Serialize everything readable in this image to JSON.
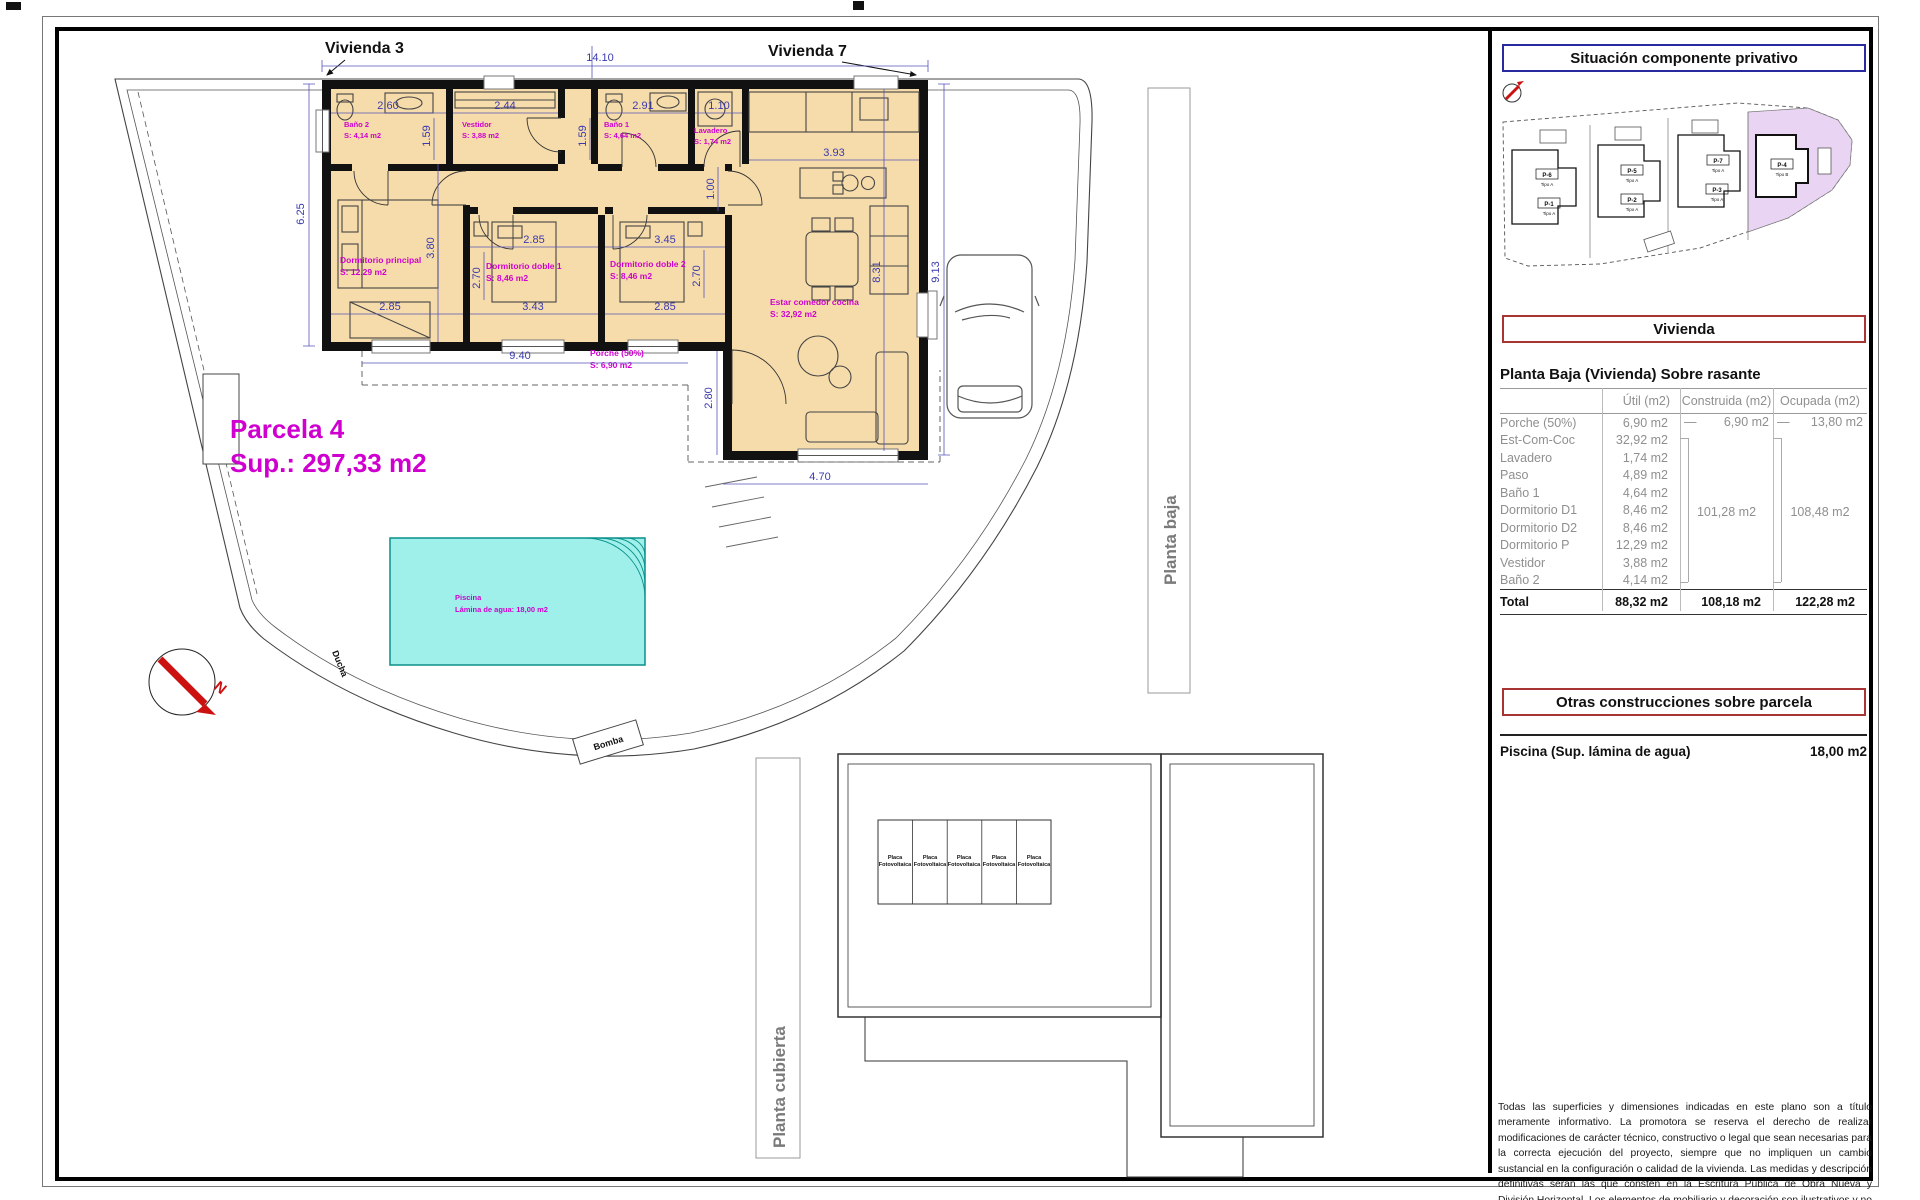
{
  "titles": {
    "vivienda3": "Vivienda 3",
    "vivienda7": "Vivienda 7"
  },
  "parcela": {
    "name": "Parcela 4",
    "area": "Sup.: 297,33 m2"
  },
  "rooms": {
    "bano2": {
      "name": "Baño 2",
      "area": "S: 4,14 m2"
    },
    "vestidor": {
      "name": "Vestidor",
      "area": "S: 3,88 m2"
    },
    "bano1": {
      "name": "Baño 1",
      "area": "S: 4,64 m2"
    },
    "lavadero": {
      "name": "Lavadero",
      "area": "S: 1,74 m2"
    },
    "dormp": {
      "name": "Dormitorio principal",
      "area": "S: 12,29 m2"
    },
    "doble1": {
      "name": "Dormitorio doble 1",
      "area": "S: 8,46 m2"
    },
    "doble2": {
      "name": "Dormitorio doble 2",
      "area": "S: 8,46 m2"
    },
    "estar": {
      "name": "Estar comedor cocina",
      "area": "S: 32,92 m2"
    },
    "porche": {
      "name": "Porche (50%)",
      "area": "S: 6,90 m2"
    }
  },
  "piscina": {
    "name": "Piscina",
    "area": "Lámina de agua: 18,00 m2"
  },
  "dims": {
    "total_w": "14.10",
    "left_h": "6.25",
    "right_h": "9.13",
    "bano2_w": "2.60",
    "vestidor_w": "2.44",
    "bano1_w": "2.91",
    "lavadero_w": "1.10",
    "bano2_d": "1.59",
    "bano1_d": "1.59",
    "paso_w": "1.00",
    "cocina_w": "3.93",
    "estar_h": "8.31",
    "doble1_w": "2.85",
    "doble2_w": "3.45",
    "doble1_d": "2.70",
    "doble2_d": "2.70",
    "dormp_d": "3.80",
    "dormp_w": "2.85",
    "doble1_wb": "3.43",
    "doble2_wb": "2.85",
    "porche_w": "9.40",
    "estar_sw_h": "2.80",
    "estar_sw_w": "4.70"
  },
  "site_labels": {
    "ducha": "Ducha",
    "bomba": "Bomba",
    "planta_baja": "Planta baja",
    "planta_cubierta": "Planta cubierta",
    "north": "N"
  },
  "solar": {
    "line1": "Placa",
    "line2": "Fotovoltaica"
  },
  "panel": {
    "situacion_title": "Situación componente privativo",
    "site_parcels": [
      {
        "id": "P-6",
        "tipo": "Tipo A"
      },
      {
        "id": "P-1",
        "tipo": "Tipo A"
      },
      {
        "id": "P-5",
        "tipo": "Tipo A"
      },
      {
        "id": "P-2",
        "tipo": "Tipo A"
      },
      {
        "id": "P-7",
        "tipo": "Tipo A"
      },
      {
        "id": "P-3",
        "tipo": "Tipo A"
      },
      {
        "id": "P-4",
        "tipo": "Tipo B"
      }
    ],
    "vivienda_title": "Vivienda",
    "table": {
      "title": "Planta Baja (Vivienda) Sobre rasante",
      "headers": [
        "Útil (m2)",
        "Construida (m2)",
        "Ocupada (m2)"
      ],
      "rows": [
        {
          "name": "Porche (50%)",
          "util": "6,90 m2"
        },
        {
          "name": "Est-Com-Coc",
          "util": "32,92 m2"
        },
        {
          "name": "Lavadero",
          "util": "1,74 m2"
        },
        {
          "name": "Paso",
          "util": "4,89 m2"
        },
        {
          "name": "Baño 1",
          "util": "4,64 m2"
        },
        {
          "name": "Dormitorio D1",
          "util": "8,46 m2"
        },
        {
          "name": "Dormitorio D2",
          "util": "8,46 m2"
        },
        {
          "name": "Dormitorio P",
          "util": "12,29 m2"
        },
        {
          "name": "Vestidor",
          "util": "3,88 m2"
        },
        {
          "name": "Baño 2",
          "util": "4,14 m2"
        }
      ],
      "porche": {
        "construida_dash": "—",
        "construida": "6,90 m2",
        "ocupada_dash": "—",
        "ocupada": "13,80 m2"
      },
      "construida_group": "101,28 m2",
      "ocupada_group": "108,48 m2",
      "total": {
        "name": "Total",
        "util": "88,32 m2",
        "construida": "108,18 m2",
        "ocupada": "122,28 m2"
      }
    },
    "otras_title": "Otras construcciones sobre parcela",
    "piscina_label": "Piscina (Sup. lámina de agua)",
    "piscina_value": "18,00 m2",
    "disclaimer": "Todas las superficies y dimensiones indicadas en este plano son a título meramente informativo. La promotora se reserva el derecho de realizar modificaciones de carácter técnico, constructivo o legal que sean necesarias para la correcta ejecución del proyecto, siempre que no impliquen un cambio sustancial en la configuración o calidad de la vivienda. Las medidas y descripción definitivas serán las que consten en la Escritura Pública de Obra Nueva y División Horizontal. Los elementos de mobiliario y decoración son ilustrativos y no están incluidos."
  }
}
